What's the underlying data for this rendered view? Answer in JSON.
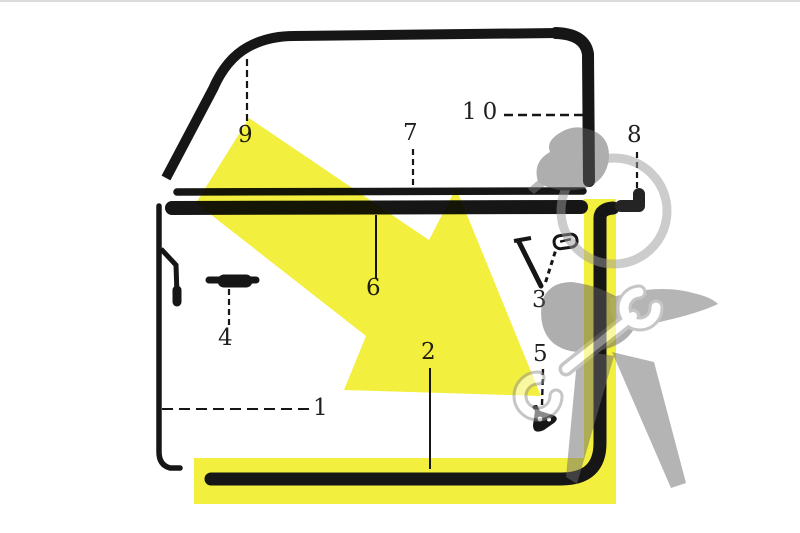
{
  "image": {
    "description": "Scanned exploded parts diagram of a car door window seal set with numbered callouts, yellow highlight arrow and supplier watermark",
    "background_color": "#ffffff",
    "line_color": "#161616",
    "highlight_color": "#f3ef3e",
    "border_color": "#dcdcdc",
    "watermark_icon": "mechanic-figure-with-wrench"
  },
  "callouts": [
    {
      "label": "1"
    },
    {
      "label": "2"
    },
    {
      "label": "3"
    },
    {
      "label": "4"
    },
    {
      "label": "5"
    },
    {
      "label": "6"
    },
    {
      "label": "7"
    },
    {
      "label": "8"
    },
    {
      "label": "9"
    },
    {
      "label": "10"
    }
  ]
}
